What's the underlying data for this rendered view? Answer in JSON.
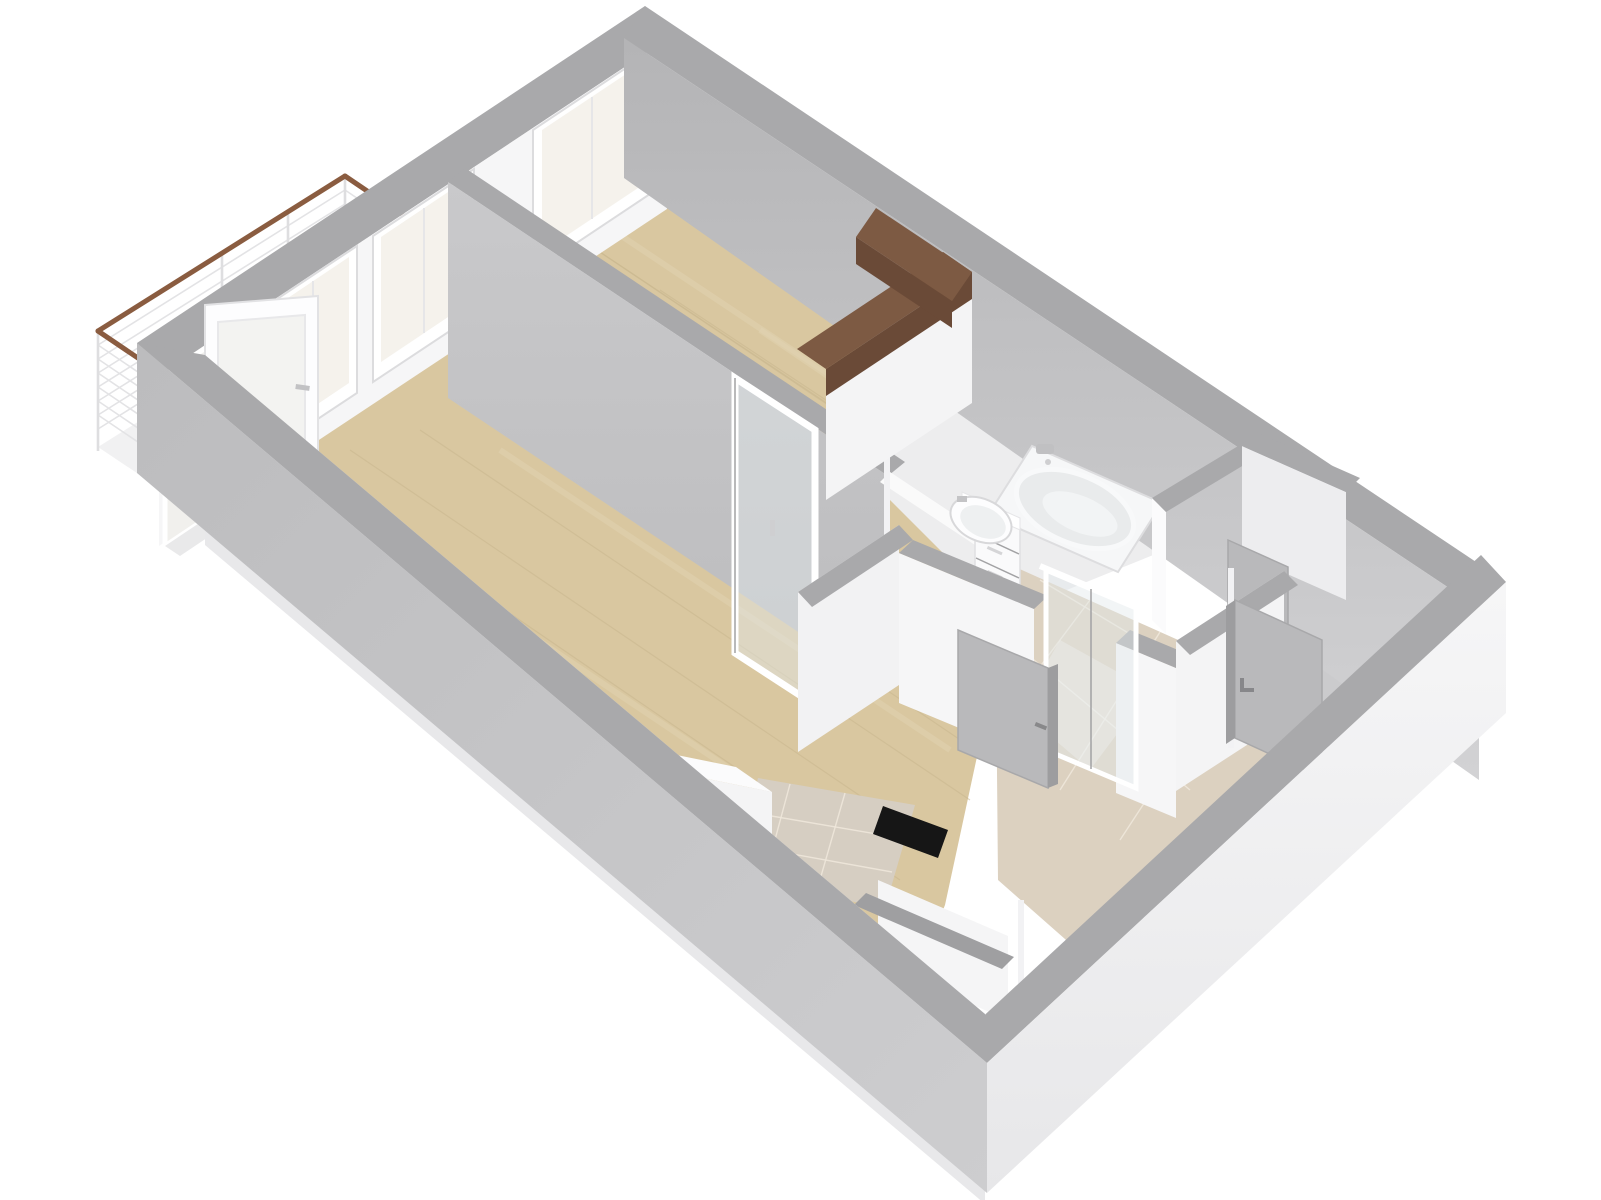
{
  "title": "3D apartment floor plan render",
  "colors": {
    "background": "#ffffff",
    "wall_top": "#a9a9ab",
    "wall_top_dark": "#9f9fa1",
    "interior_white": "#f6f6f7",
    "interior_shadow": "#c4c4c6",
    "outer_face_light": "#f2f2f3",
    "outer_face_gray": "#c2c2c4",
    "wood_floor": "#d9c7a0",
    "kitchen_tile": "#d6cec2",
    "hall_tile": "#dcd1c0",
    "bathroom_floor": "#ededee",
    "balcony_floor": "#f1f1f2",
    "window_glass": "#f5f2ec",
    "glass_tint": "rgba(226,232,236,0.45)",
    "wardrobe_top": "#7d5a43",
    "wardrobe_side": "#6a4a37",
    "railing_wood": "#8a5c40",
    "door_gray": "#b9b9bb",
    "door_gray_edge": "#a6a6a8",
    "fixture_white": "#f6f7f8",
    "black_accent": "#161616"
  },
  "scene": {
    "type": "axonometric-3d-floorplan",
    "background": "white",
    "rooms": [
      {
        "id": "bedroom",
        "floor": "wood"
      },
      {
        "id": "living-room",
        "floor": "wood"
      },
      {
        "id": "kitchen-corner",
        "floor": "tile"
      },
      {
        "id": "bathroom",
        "floor": "white"
      },
      {
        "id": "hallway",
        "floor": "beige-tile"
      },
      {
        "id": "closet",
        "floor": "gray"
      },
      {
        "id": "entry-room",
        "floor": "gray"
      },
      {
        "id": "utility-niche",
        "floor": "white"
      },
      {
        "id": "balcony",
        "floor": "white"
      }
    ],
    "objects": [
      "balcony-railing",
      "balcony-door-open",
      "window",
      "window",
      "window",
      "glass-interior-door",
      "wardrobe-l-shaped",
      "bathtub",
      "sink-vanity",
      "sliding-glass-door",
      "interior-door-open",
      "entry-door-open",
      "closet-door-open",
      "kitchen-counter",
      "black-appliance-strip"
    ]
  }
}
